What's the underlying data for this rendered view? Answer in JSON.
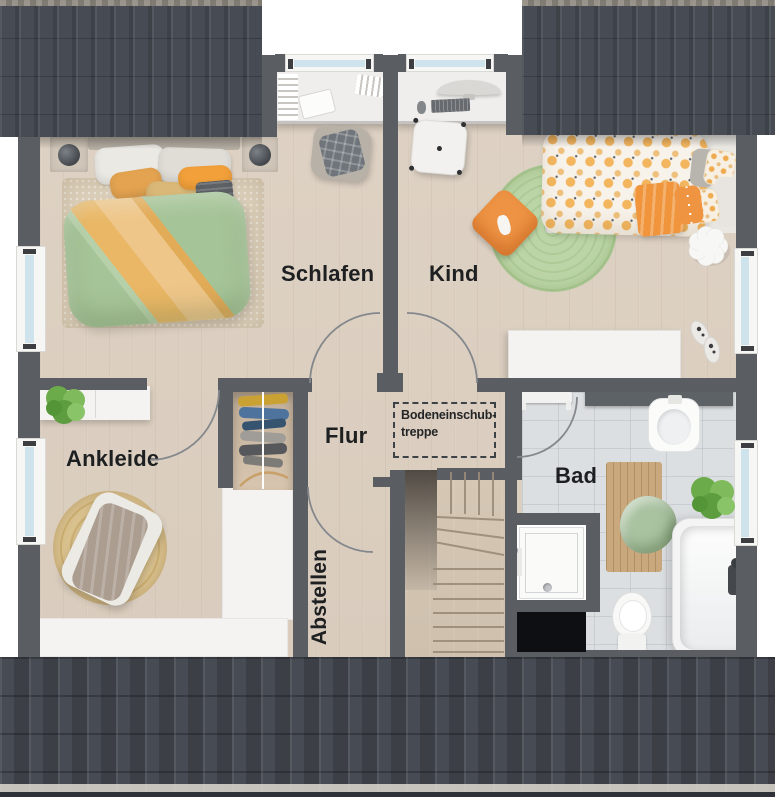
{
  "rooms": {
    "schlafen": {
      "label": "Schlafen"
    },
    "kind": {
      "label": "Kind"
    },
    "flur": {
      "label": "Flur"
    },
    "ankleide": {
      "label": "Ankleide"
    },
    "abstellen": {
      "label": "Abstellen"
    },
    "bad": {
      "label": "Bad"
    }
  },
  "annotations": {
    "attic_hatch": {
      "line1": "Bodeneinschub-",
      "line2": "treppe"
    }
  },
  "colors": {
    "wall": "#5a5e63",
    "roof": "#474c54",
    "wood": "#d9ccbd",
    "tile": "#dcdfe1",
    "white_area": "#f4f3f1",
    "rug_beige": "#dbcfba",
    "rug_green": "#b5d2a0",
    "rug_jute": "#d5bc89",
    "duvet_green": "#a5c497",
    "duvet_orange": "#e9b765",
    "accent_orange": "#ee9344",
    "plant_green": "#6cab4a",
    "glass": "#cfe3ed",
    "text": "#1d1f21"
  }
}
